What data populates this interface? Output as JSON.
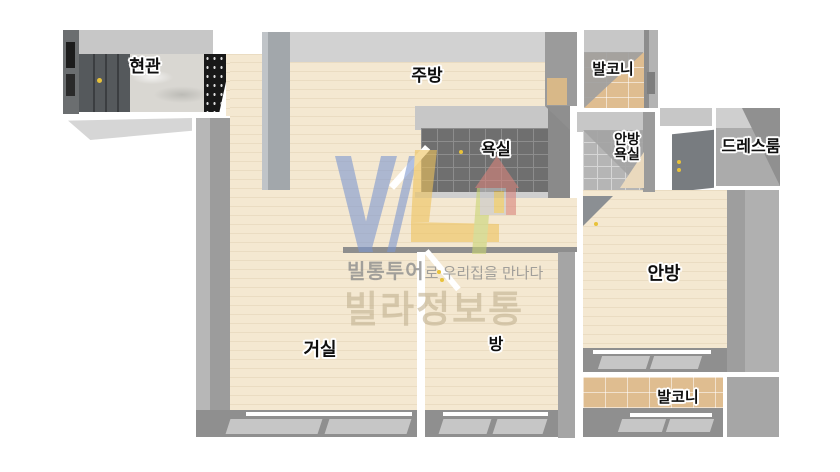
{
  "rooms": {
    "entrance": {
      "label": "현관"
    },
    "kitchen": {
      "label": "주방"
    },
    "balcony_top": {
      "label": "발코니"
    },
    "bathroom": {
      "label": "욕실"
    },
    "master_bathroom": {
      "line1": "안방",
      "line2": "욕실"
    },
    "dressroom": {
      "label": "드레스룸"
    },
    "master_bedroom": {
      "label": "안방"
    },
    "living_room": {
      "label": "거실"
    },
    "room": {
      "label": "방"
    },
    "balcony_bottom": {
      "label": "발코니"
    }
  },
  "watermark": {
    "brand_prefix": "빌통투어",
    "tagline_suffix": "로 우리집을 만나다",
    "brand_name": "빌라정보통",
    "logo_colors": {
      "v": "#7d97d0",
      "l": "#eec35c",
      "bar": "#c9d574",
      "roof": "#d8837c",
      "body": "#c6c6c6",
      "door": "#e7c253"
    }
  },
  "palette": {
    "wall_light": "#d2d2d2",
    "wall_mid": "#a6a6a6",
    "wall_dark": "#8f8f8f",
    "floor_wood": "#f4e8d1",
    "tile_dark": "#6f6f6f",
    "tile_light": "#b5b5b5",
    "tile_tan": "#dfbd90",
    "accent_yellow": "#e8c23a",
    "door_gray": "#55595c"
  }
}
